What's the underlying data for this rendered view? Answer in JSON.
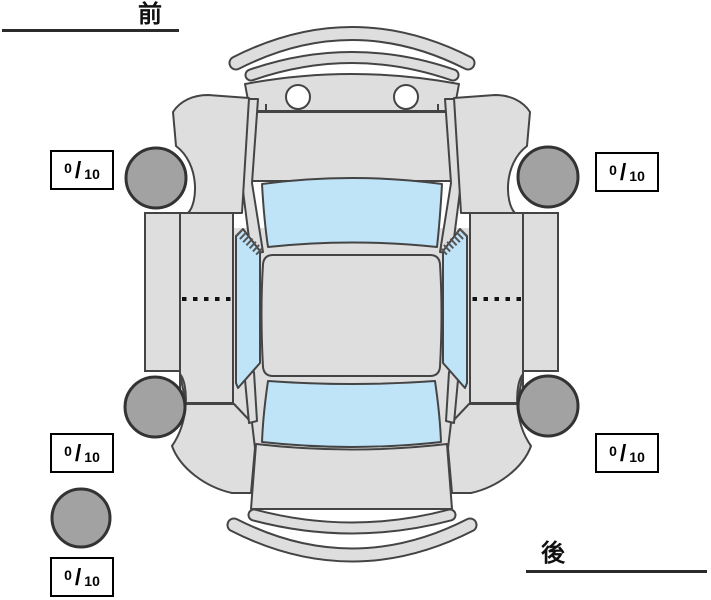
{
  "labels": {
    "front": "前",
    "rear": "後"
  },
  "scores": {
    "front_left": {
      "value": "0",
      "slash": "/",
      "max": "10"
    },
    "front_right": {
      "value": "0",
      "slash": "/",
      "max": "10"
    },
    "rear_left": {
      "value": "0",
      "slash": "/",
      "max": "10"
    },
    "rear_right": {
      "value": "0",
      "slash": "/",
      "max": "10"
    },
    "spare": {
      "value": "0",
      "slash": "/",
      "max": "10"
    }
  },
  "diagram": {
    "type": "car-top-view-condition-map",
    "tires": [
      "front-left",
      "front-right",
      "rear-left",
      "rear-right",
      "spare"
    ],
    "colors": {
      "body": "#dedede",
      "window": "#bfe3f7",
      "tire": "#a2a2a2",
      "outline": "#444444",
      "box_border": "#000000",
      "background": "#ffffff"
    }
  }
}
